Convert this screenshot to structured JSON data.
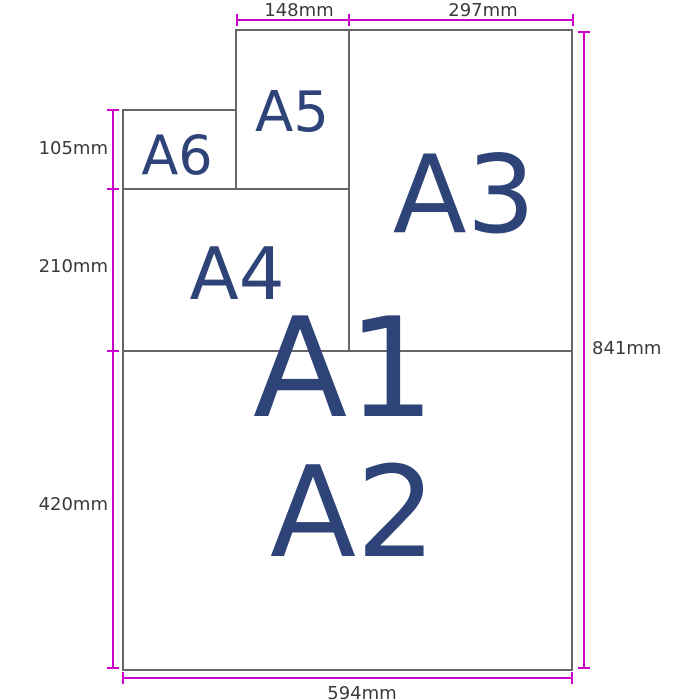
{
  "colors": {
    "dimension_line": "#cc00cc",
    "paper_border": "#666666",
    "paper_label_text": "#2e4478",
    "dimension_text": "#3a3a3a",
    "background": "#ffffff"
  },
  "papers": {
    "a1": {
      "label": "A1"
    },
    "a2": {
      "label": "A2"
    },
    "a3": {
      "label": "A3"
    },
    "a4": {
      "label": "A4"
    },
    "a5": {
      "label": "A5"
    },
    "a6": {
      "label": "A6"
    }
  },
  "measurements": {
    "a5_width": {
      "value": "148mm",
      "edge": "top"
    },
    "a3_width": {
      "value": "297mm",
      "edge": "top"
    },
    "a6_height": {
      "value": "105mm",
      "edge": "left"
    },
    "a4_height": {
      "value": "210mm",
      "edge": "left"
    },
    "a2_height": {
      "value": "420mm",
      "edge": "left"
    },
    "a1_height": {
      "value": "841mm",
      "edge": "right"
    },
    "a1_width": {
      "value": "594mm",
      "edge": "bottom"
    }
  }
}
